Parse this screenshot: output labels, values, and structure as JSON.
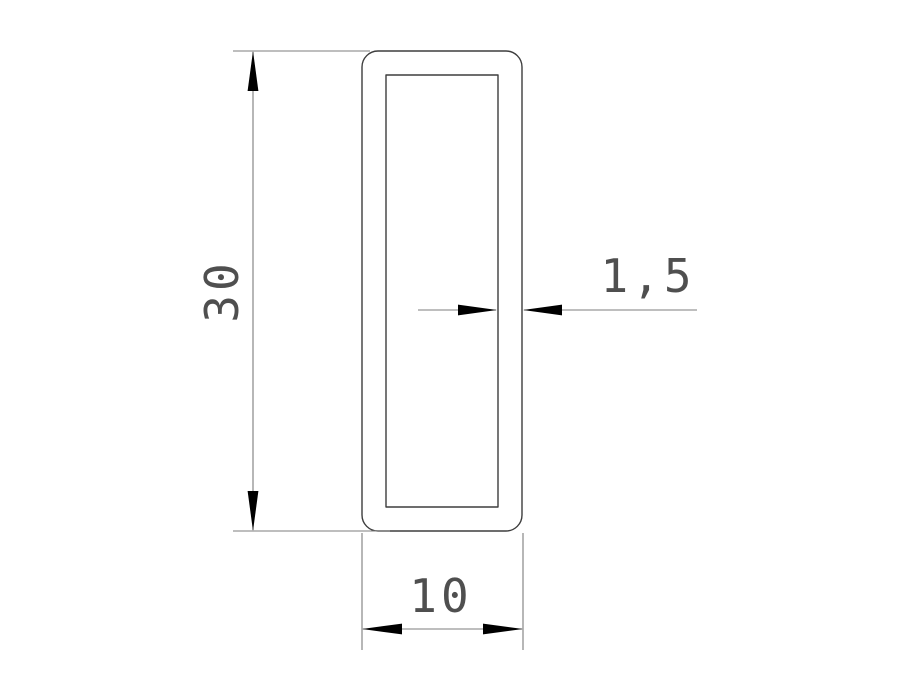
{
  "drawing": {
    "type": "technical-drawing",
    "subject": "Rectangular hollow tube profile cross-section",
    "labels": {
      "height": "30",
      "thickness": "1,5",
      "width": "10"
    },
    "colors": {
      "background": "#ffffff",
      "profile_outline": "#3d3d3d",
      "dimension_lines": "#7c7c7c",
      "arrowheads": "#000000",
      "dimension_text": "#4f4f4f"
    }
  }
}
